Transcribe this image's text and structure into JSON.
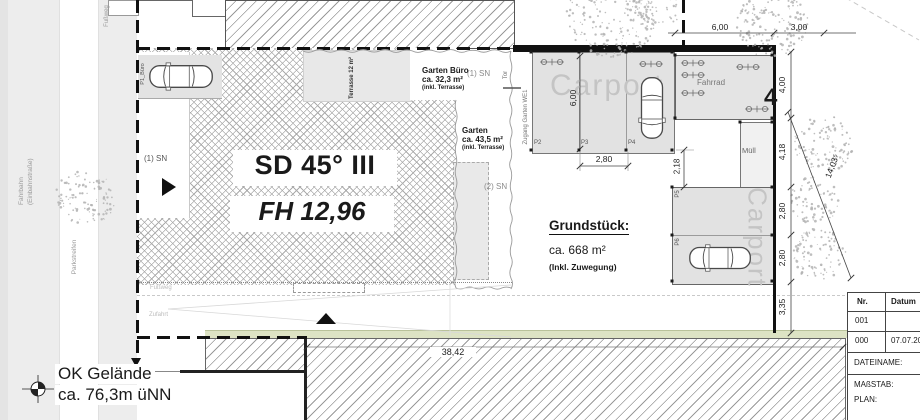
{
  "plan": {
    "building": {
      "roof": "SD 45° III",
      "height": "FH 12,96"
    },
    "plot": {
      "title": "Grundstück:",
      "area": "ca. 668 m²",
      "note": "(Inkl. Zuwegung)"
    },
    "garden_office": {
      "title": "Garten Büro",
      "area": "ca. 32,3 m²",
      "note": "(inkl. Terrasse)"
    },
    "garden": {
      "title": "Garten",
      "area": "ca. 43,5 m²",
      "note": "(inkl. Terrasse)"
    },
    "terrace_note": "Terrasse 12 m²",
    "access": {
      "zugang": "Zugang Garten WE1",
      "tor": "Tor"
    },
    "zones": {
      "carport_top": "Carport",
      "carport_right": "Carport",
      "fahrrad": "Fahrrad",
      "muell": "Müll"
    },
    "parking": {
      "p1": "P1_Büro",
      "p2": "P2",
      "p3": "P3",
      "p4": "P4",
      "p5": "P5",
      "p6": "P6"
    },
    "street": {
      "fahrbahn_line1": "Fahrbahn",
      "fahrbahn_line2": "(Einbahnstraße)",
      "parkstreifen": "Parkstreifen",
      "fussweg_top": "Fußweg",
      "fussweg": "Fußweg",
      "zufahrt": "Zufahrt"
    },
    "marks": {
      "sn1_left": "(1) SN",
      "sn1_top": "(1) SN",
      "sn2": "(2) SN",
      "house_number": "4"
    },
    "level": {
      "line1": "OK Gelände",
      "line2": "ca. 76,3m üNN"
    },
    "dimensions": {
      "top_6": "6,00",
      "top_3": "3,00",
      "chain": [
        "4,00",
        "4,18",
        "2,80",
        "2,80",
        "3,35"
      ],
      "diagonal": "14,03⁵",
      "carport_width": "2,80",
      "carport_depth": "6,00",
      "gap": "2,18",
      "frontage": "38,42"
    }
  },
  "titleblock": {
    "col_nr": "Nr.",
    "col_datum": "Datum",
    "row1_nr": "001",
    "row1_datum": "",
    "row2_nr": "000",
    "row2_datum": "07.07.201",
    "dateiname": "DATEINAME:",
    "massstab": "MAßSTAB:",
    "plan": "PLAN:"
  },
  "colors": {
    "accent_green": "#dde3c4",
    "hatch_gray": "#ababab",
    "carport_text_gray": "#c4c4c4"
  }
}
